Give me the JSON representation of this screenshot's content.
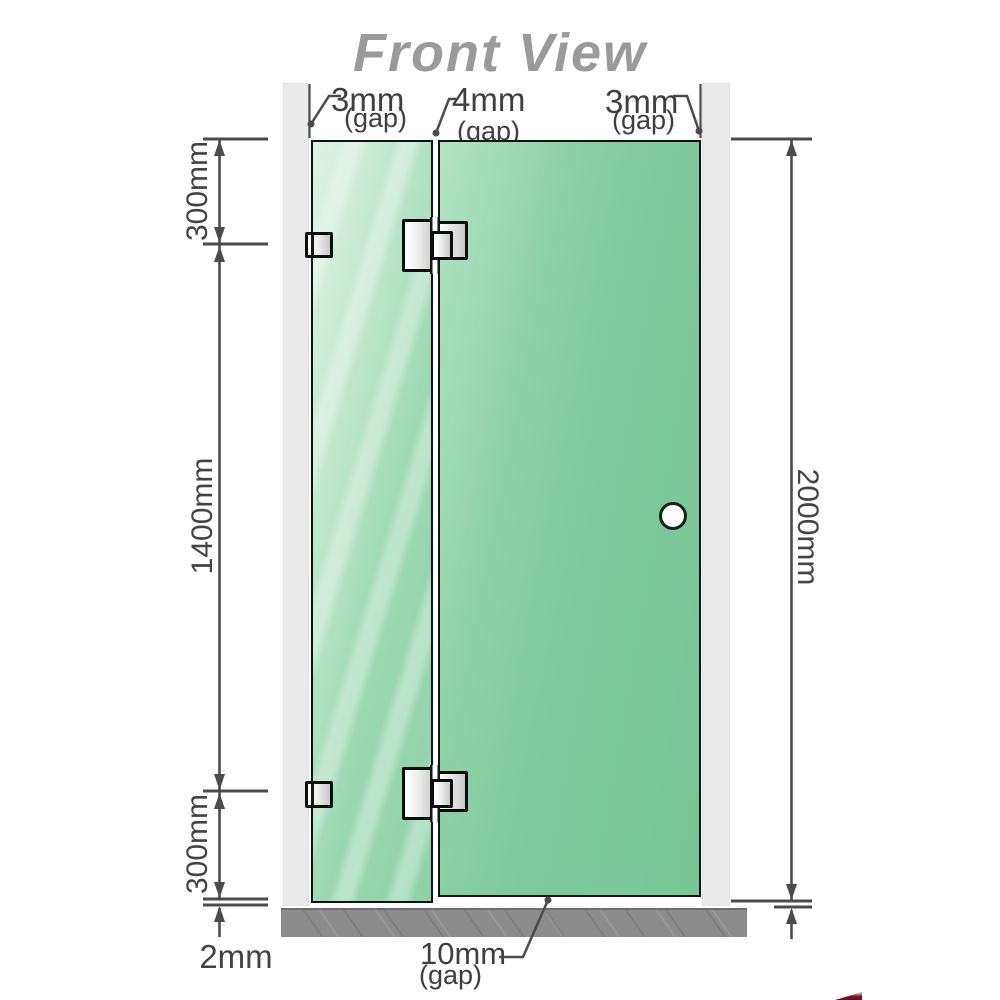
{
  "title": "Front View",
  "gaps": {
    "left": {
      "value": "3mm",
      "unit": "(gap)"
    },
    "middle": {
      "value": "4mm",
      "unit": "(gap)"
    },
    "right": {
      "value": "3mm",
      "unit": "(gap)"
    },
    "bottom": {
      "value": "10mm",
      "unit": "(gap)"
    }
  },
  "dimensions": {
    "top_segment": "300mm",
    "middle_segment": "1400mm",
    "bottom_segment": "300mm",
    "floor_gap": "2mm",
    "total_height": "2000mm"
  },
  "colors": {
    "title": "#9a9a9a",
    "wall": "#ebebeb",
    "glass_light": "#bce6cb",
    "glass_dark": "#7fca9d",
    "floor": "#8c8c8c",
    "line": "#434343",
    "logo": "#7e1427"
  }
}
